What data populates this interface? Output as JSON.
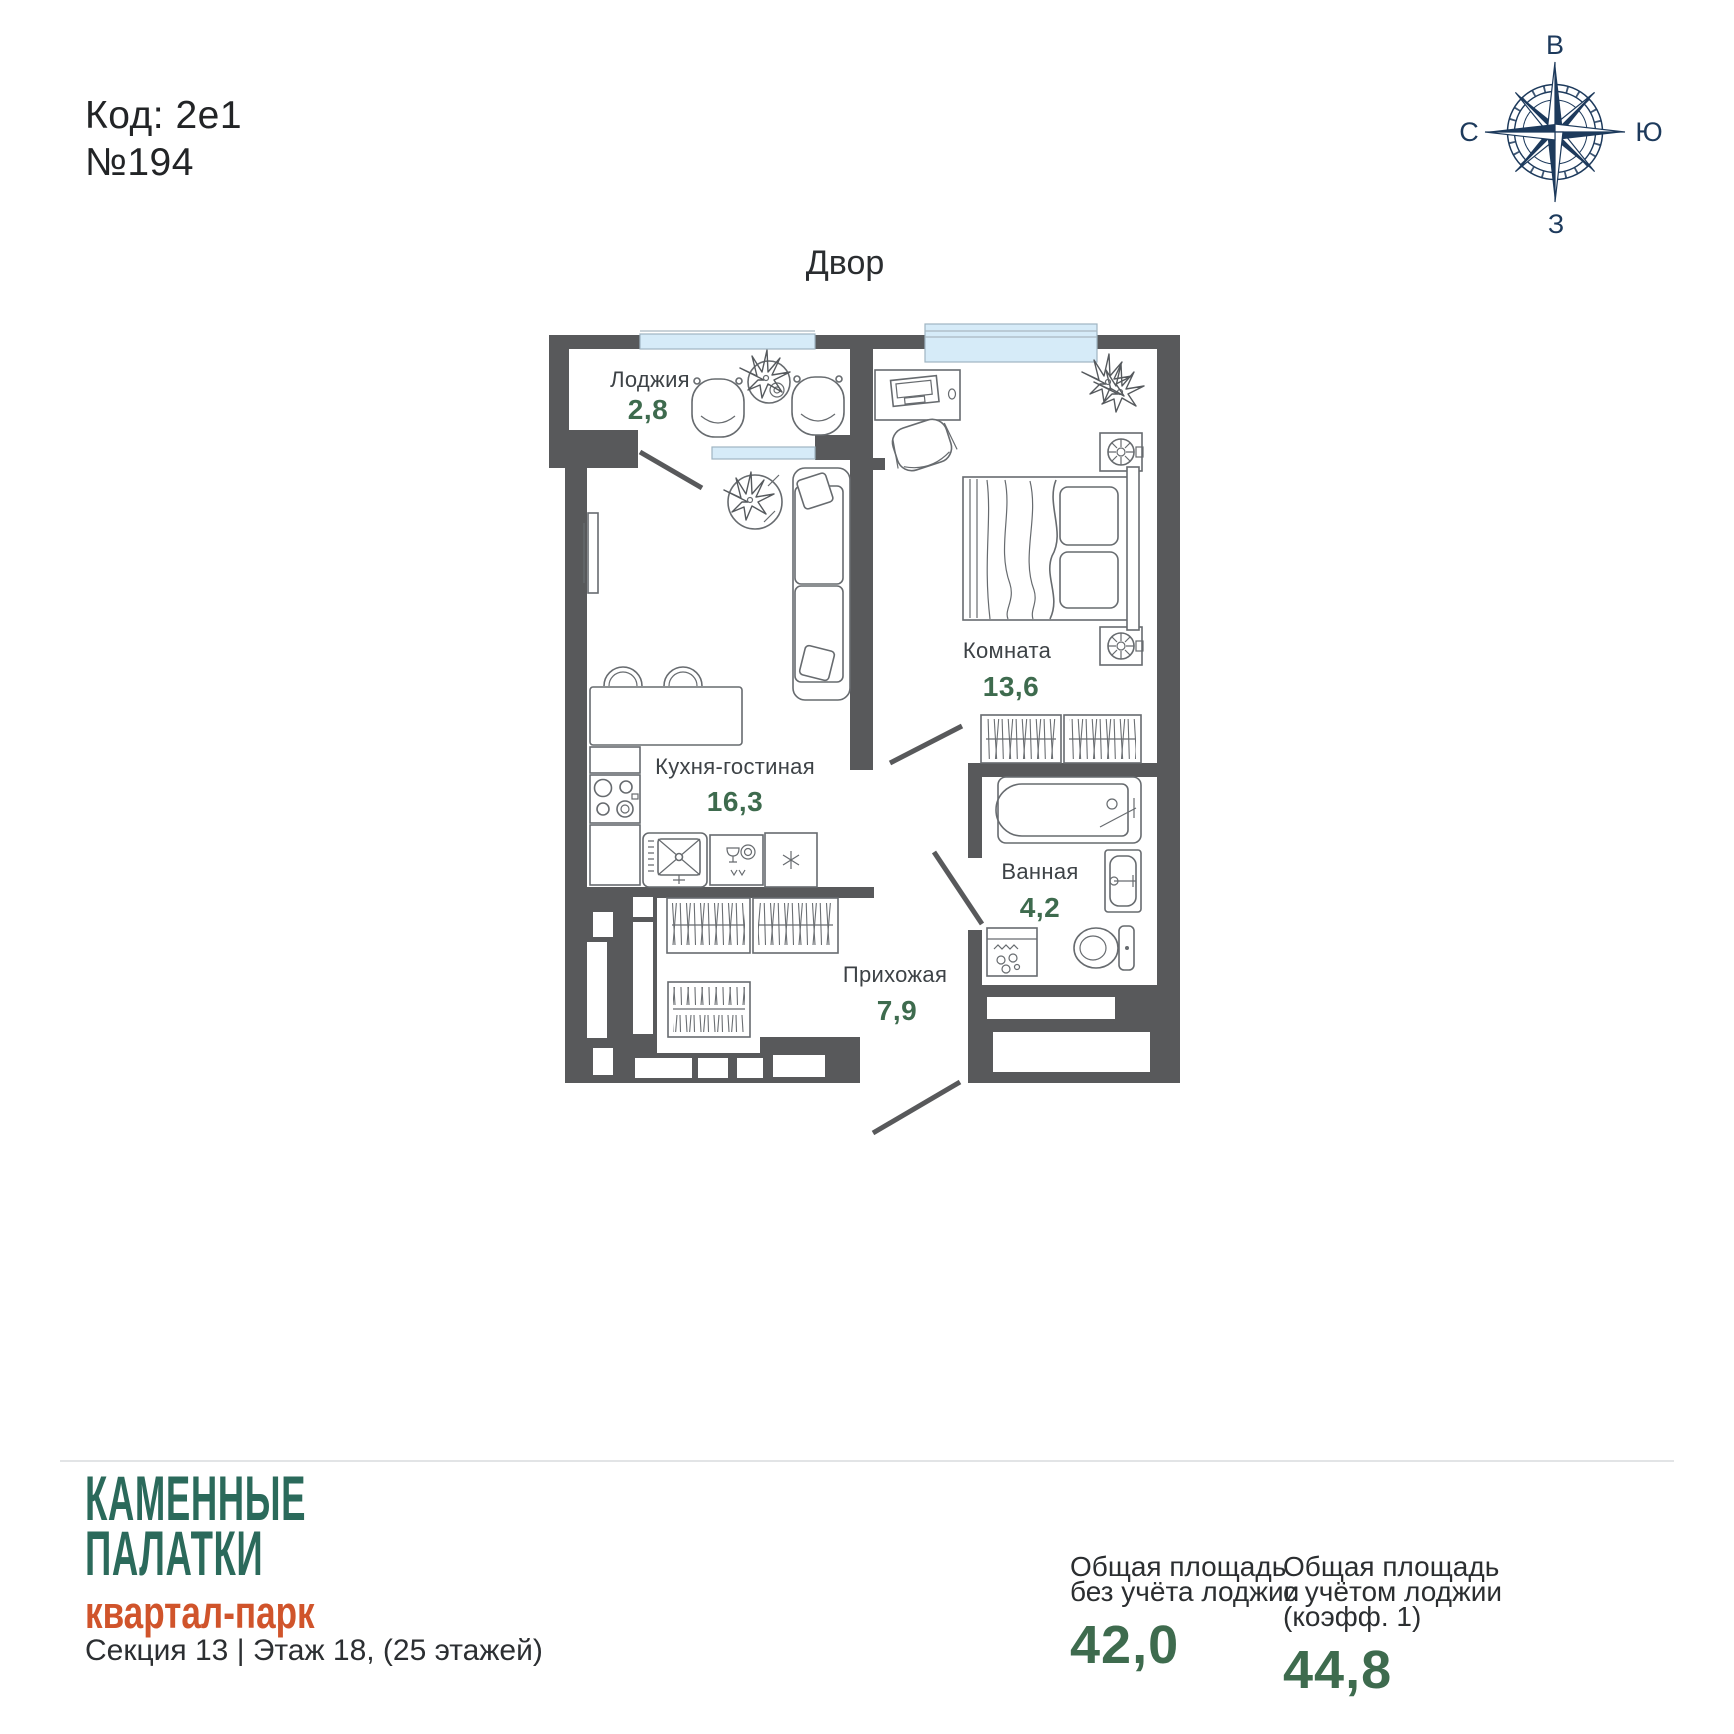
{
  "header": {
    "code": "Код: 2е1",
    "number": "№194"
  },
  "compass": {
    "top": "В",
    "right": "Ю",
    "bottom": "З",
    "left": "С",
    "color": "#1d3a5c"
  },
  "plan": {
    "yard_label": "Двор",
    "wall_color": "#58595b",
    "window_color": "#d6ebf8",
    "area_value_color": "#3e6b4e",
    "rooms": [
      {
        "id": "loggia",
        "name": "Лоджия",
        "area": "2,8"
      },
      {
        "id": "kitchen",
        "name": "Кухня-гостиная",
        "area": "16,3"
      },
      {
        "id": "bedroom",
        "name": "Комната",
        "area": "13,6"
      },
      {
        "id": "bathroom",
        "name": "Ванная",
        "area": "4,2"
      },
      {
        "id": "hallway",
        "name": "Прихожая",
        "area": "7,9"
      }
    ]
  },
  "footer": {
    "brand": {
      "line1": "КАМЕННЫЕ",
      "line2": "ПАЛАТКИ",
      "subtitle": "квартал-парк",
      "brand_color": "#2b6a5b",
      "subtitle_color": "#d0542b"
    },
    "section_info": "Секция 13 | Этаж 18, (25 этажей)",
    "stats": [
      {
        "label_line1": "Общая площадь",
        "label_line2": "без учёта лоджии",
        "value": "42,0"
      },
      {
        "label_line1": "Общая площадь",
        "label_line2": "с учётом лоджии (коэфф. 1)",
        "value": "44,8"
      }
    ]
  }
}
